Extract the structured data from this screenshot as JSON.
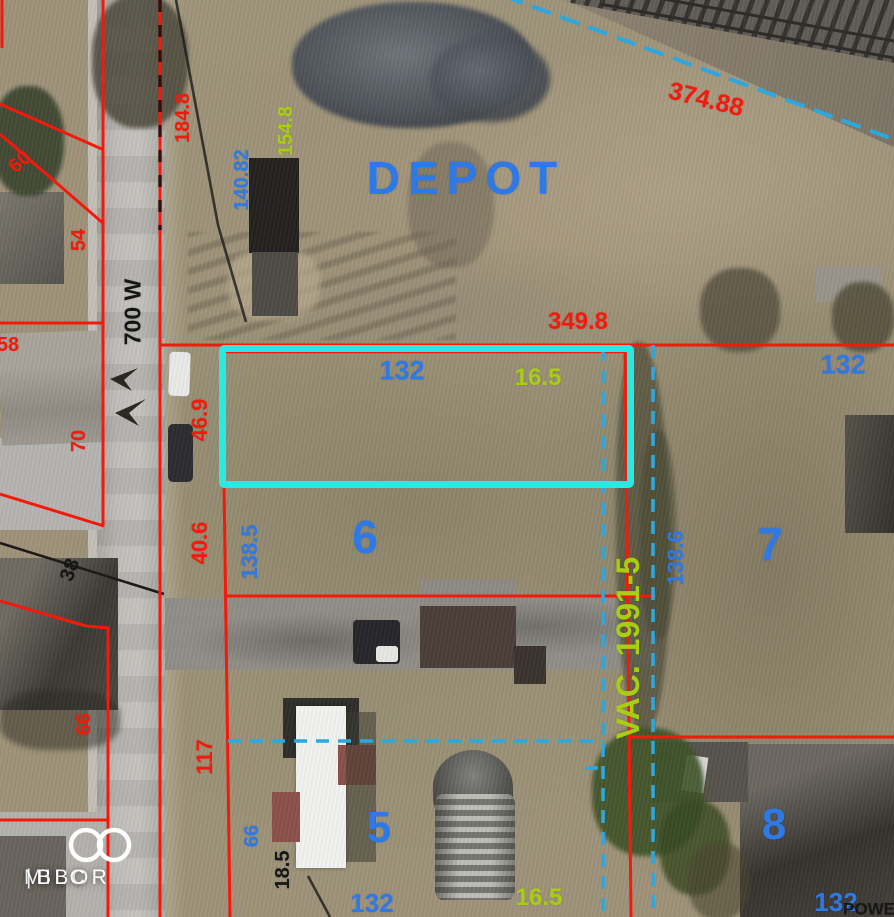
{
  "colors": {
    "red": "#f5190c",
    "blue": "#2e79e6",
    "green": "#a9ce11",
    "black": "#161616",
    "cyan": "#2be9e0",
    "dashblue": "#2ea7dd",
    "white": "#ffffff"
  },
  "map": {
    "type": "aerial-parcel-map",
    "street_name": "700 W",
    "area_label": "DEPOT",
    "vacation_note": "VAC. 1991-5",
    "highlighted_parcel": {
      "width_label": "132",
      "depth_label": "16.5"
    }
  },
  "labels": [
    {
      "name": "dim-184-8",
      "text": "184.8",
      "x": 183,
      "y": 118,
      "rot": -90,
      "size": 20,
      "color": "red"
    },
    {
      "name": "dim-154-8",
      "text": "154.8",
      "x": 286,
      "y": 131,
      "rot": -90,
      "size": 20,
      "color": "green"
    },
    {
      "name": "dim-140-82",
      "text": "140.82",
      "x": 242,
      "y": 180,
      "rot": -90,
      "size": 20,
      "color": "blue"
    },
    {
      "name": "depot-label",
      "text": "DEPOT",
      "x": 466,
      "y": 178,
      "rot": 0,
      "size": 46,
      "color": "blue",
      "spacing": 8
    },
    {
      "name": "dim-374-88",
      "text": "374.88",
      "x": 706,
      "y": 100,
      "rot": 14,
      "size": 25,
      "color": "red"
    },
    {
      "name": "dim-349-8",
      "text": "349.8",
      "x": 578,
      "y": 322,
      "rot": 0,
      "size": 24,
      "color": "red"
    },
    {
      "name": "dim-132-subject",
      "text": "132",
      "x": 402,
      "y": 371,
      "rot": 0,
      "size": 27,
      "color": "blue"
    },
    {
      "name": "dim-16-5-subject",
      "text": "16.5",
      "x": 538,
      "y": 378,
      "rot": 0,
      "size": 24,
      "color": "green"
    },
    {
      "name": "dim-132-east",
      "text": "132",
      "x": 843,
      "y": 365,
      "rot": 0,
      "size": 27,
      "color": "blue"
    },
    {
      "name": "dim-46-9",
      "text": "46.9",
      "x": 200,
      "y": 420,
      "rot": -90,
      "size": 22,
      "color": "red"
    },
    {
      "name": "street-700-w",
      "text": "700 W",
      "x": 133,
      "y": 312,
      "rot": -90,
      "size": 23,
      "color": "black"
    },
    {
      "name": "dim-60",
      "text": "60",
      "x": 20,
      "y": 162,
      "rot": -42,
      "size": 20,
      "color": "red"
    },
    {
      "name": "dim-54",
      "text": "54",
      "x": 79,
      "y": 240,
      "rot": -90,
      "size": 20,
      "color": "red"
    },
    {
      "name": "dim-58",
      "text": "58",
      "x": 8,
      "y": 345,
      "rot": 0,
      "size": 20,
      "color": "red"
    },
    {
      "name": "dim-70",
      "text": "70",
      "x": 79,
      "y": 441,
      "rot": -90,
      "size": 20,
      "color": "red"
    },
    {
      "name": "dim-38",
      "text": "38",
      "x": 70,
      "y": 570,
      "rot": -70,
      "size": 20,
      "color": "black"
    },
    {
      "name": "dim-40-6",
      "text": "40.6",
      "x": 200,
      "y": 543,
      "rot": -90,
      "size": 22,
      "color": "red"
    },
    {
      "name": "dim-138-5",
      "text": "138.5",
      "x": 250,
      "y": 552,
      "rot": -90,
      "size": 22,
      "color": "blue"
    },
    {
      "name": "lot-6",
      "text": "6",
      "x": 365,
      "y": 537,
      "rot": 0,
      "size": 46,
      "color": "blue"
    },
    {
      "name": "vacation-label",
      "text": "VAC. 1991-5",
      "x": 628,
      "y": 648,
      "rot": -90,
      "size": 32,
      "color": "green"
    },
    {
      "name": "dim-138-6",
      "text": "138.6",
      "x": 676,
      "y": 558,
      "rot": -90,
      "size": 22,
      "color": "blue"
    },
    {
      "name": "lot-7",
      "text": "7",
      "x": 770,
      "y": 544,
      "rot": 0,
      "size": 46,
      "color": "blue"
    },
    {
      "name": "dim-66-west",
      "text": "66",
      "x": 84,
      "y": 724,
      "rot": -90,
      "size": 20,
      "color": "red"
    },
    {
      "name": "dim-117",
      "text": "117",
      "x": 205,
      "y": 757,
      "rot": -90,
      "size": 22,
      "color": "red"
    },
    {
      "name": "dim-66-south",
      "text": "66",
      "x": 252,
      "y": 836,
      "rot": -90,
      "size": 20,
      "color": "blue"
    },
    {
      "name": "dim-18-5",
      "text": "18.5",
      "x": 283,
      "y": 870,
      "rot": -90,
      "size": 20,
      "color": "black"
    },
    {
      "name": "lot-5",
      "text": "5",
      "x": 379,
      "y": 828,
      "rot": 0,
      "size": 44,
      "color": "blue"
    },
    {
      "name": "dim-132-south",
      "text": "132",
      "x": 372,
      "y": 903,
      "rot": 0,
      "size": 26,
      "color": "blue"
    },
    {
      "name": "dim-16-5-south",
      "text": "16.5",
      "x": 539,
      "y": 898,
      "rot": 0,
      "size": 24,
      "color": "green"
    },
    {
      "name": "lot-8",
      "text": "8",
      "x": 774,
      "y": 825,
      "rot": 0,
      "size": 44,
      "color": "blue"
    },
    {
      "name": "dim-132-southeast",
      "text": "132",
      "x": 836,
      "y": 902,
      "rot": 0,
      "size": 26,
      "color": "blue"
    },
    {
      "name": "powerline-label",
      "text": "POWE",
      "x": 869,
      "y": 909,
      "rot": 0,
      "size": 17,
      "color": "black"
    }
  ],
  "watermark": {
    "brand_left": "MIBOR",
    "divider": "|",
    "brand_right": "BLC"
  }
}
